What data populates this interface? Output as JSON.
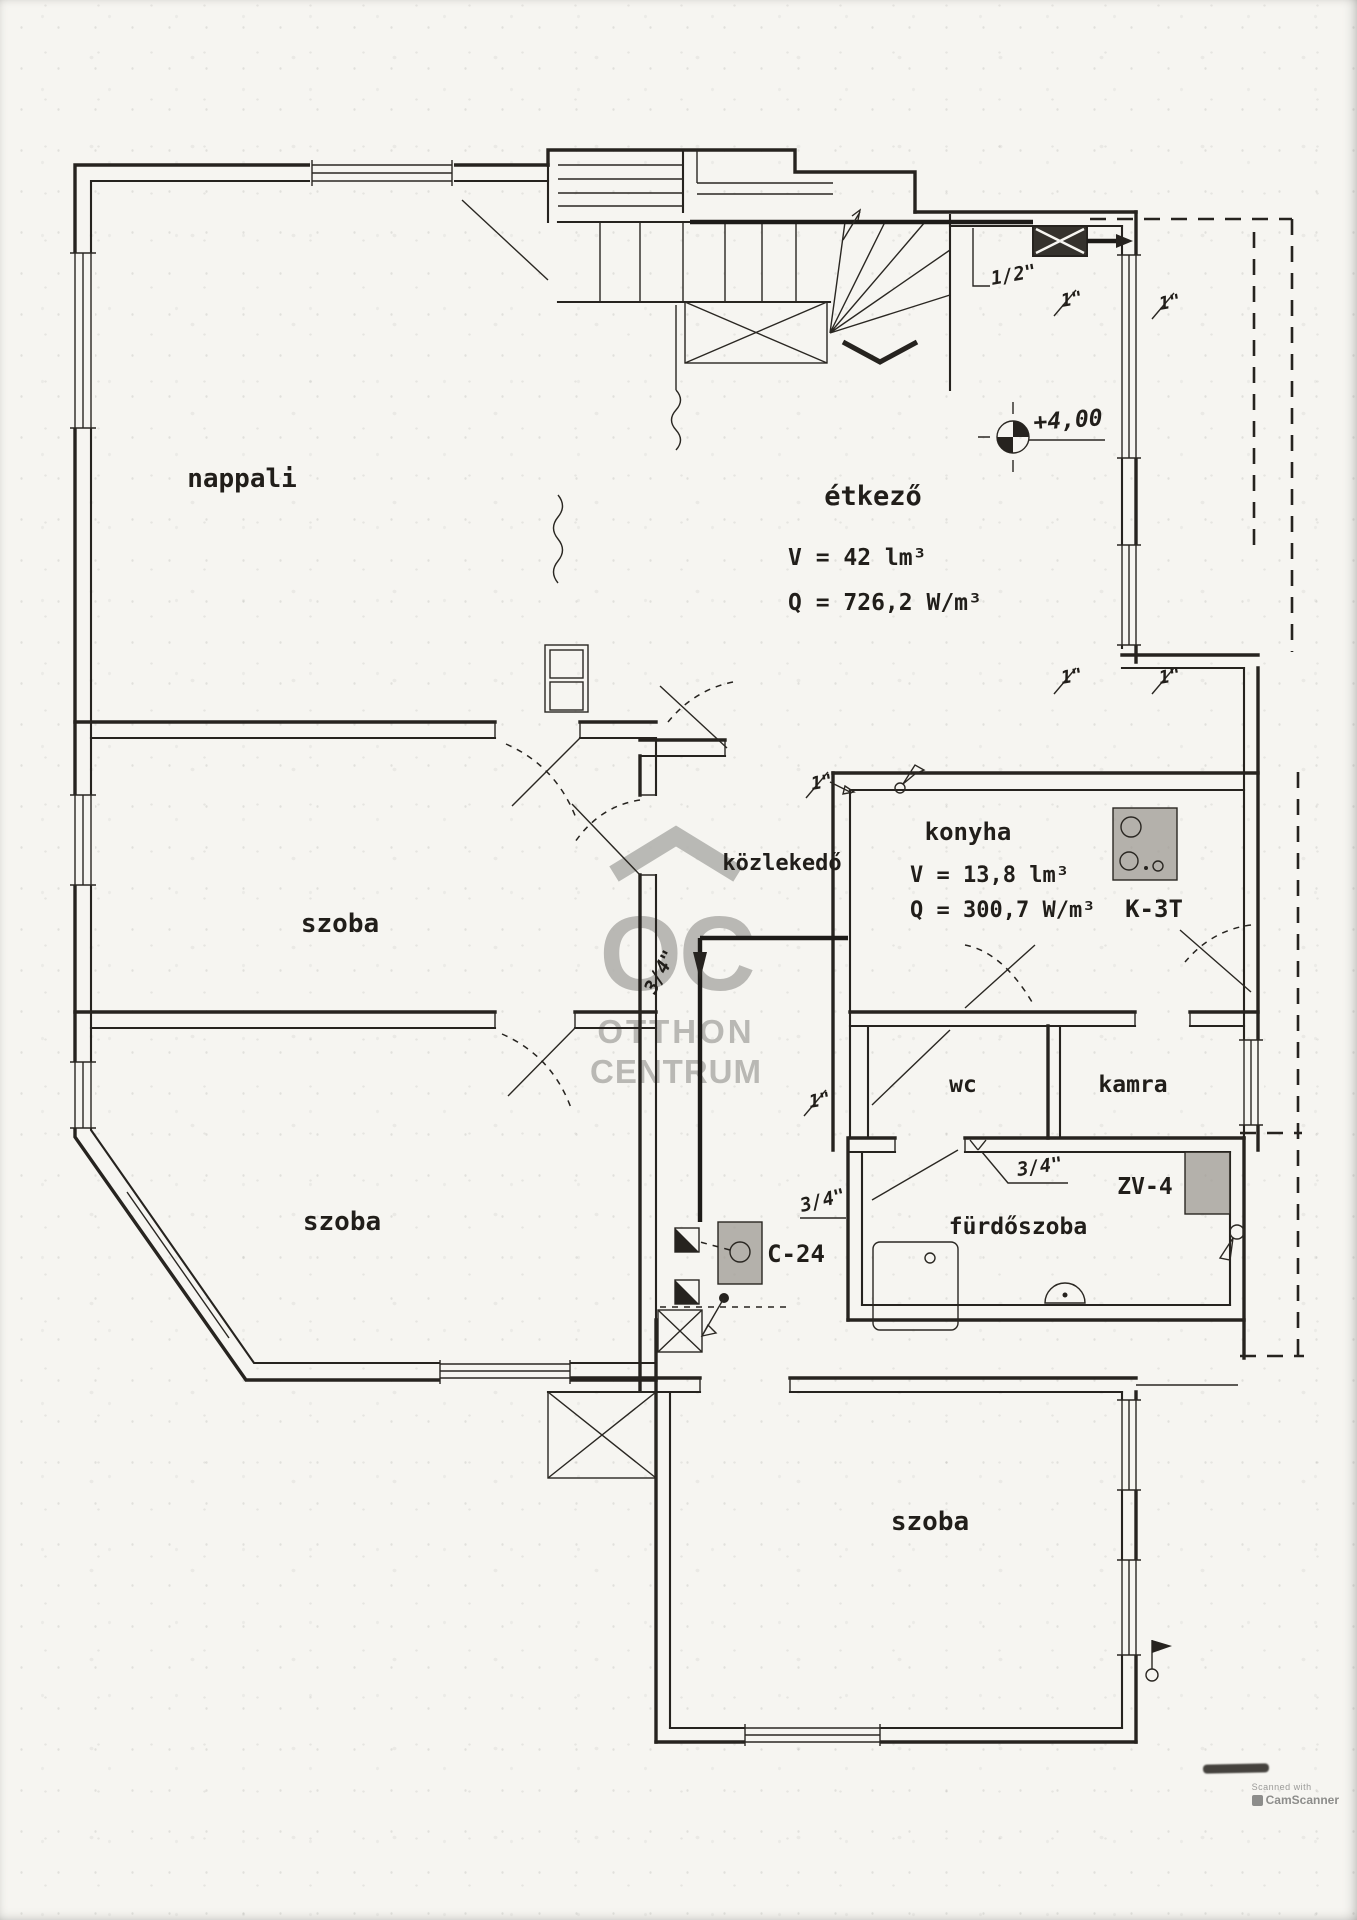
{
  "labels": {
    "nappali": "nappali",
    "etkezo": "étkező",
    "etkezo_volume": "V = 42 lm³",
    "etkezo_heat": "Q = 726,2 W/m³",
    "szoba": "szoba",
    "kozlekedo": "közlekedő",
    "konyha": "konyha",
    "konyha_volume": "V = 13,8 lm³",
    "konyha_heat": "Q = 300,7 W/m³",
    "stove": "K-3T",
    "wc": "wc",
    "kamra": "kamra",
    "furdoszoba": "fürdőszoba",
    "water_heater": "ZV-4",
    "radiator": "C-24",
    "level": "+4,00",
    "pipe_half": "1/2\"",
    "pipe_one": "1\"",
    "pipe_three_quarter": "3/4\""
  },
  "watermark": {
    "initials": "OC",
    "line1": "OTTHON",
    "line2": "CENTRUM",
    "color": "#b3b2ae"
  },
  "scanner_mark": {
    "prefix": "Scanned with",
    "brand": "CamScanner"
  },
  "colors": {
    "ink": "#26231f",
    "paper": "#f6f5f1"
  }
}
